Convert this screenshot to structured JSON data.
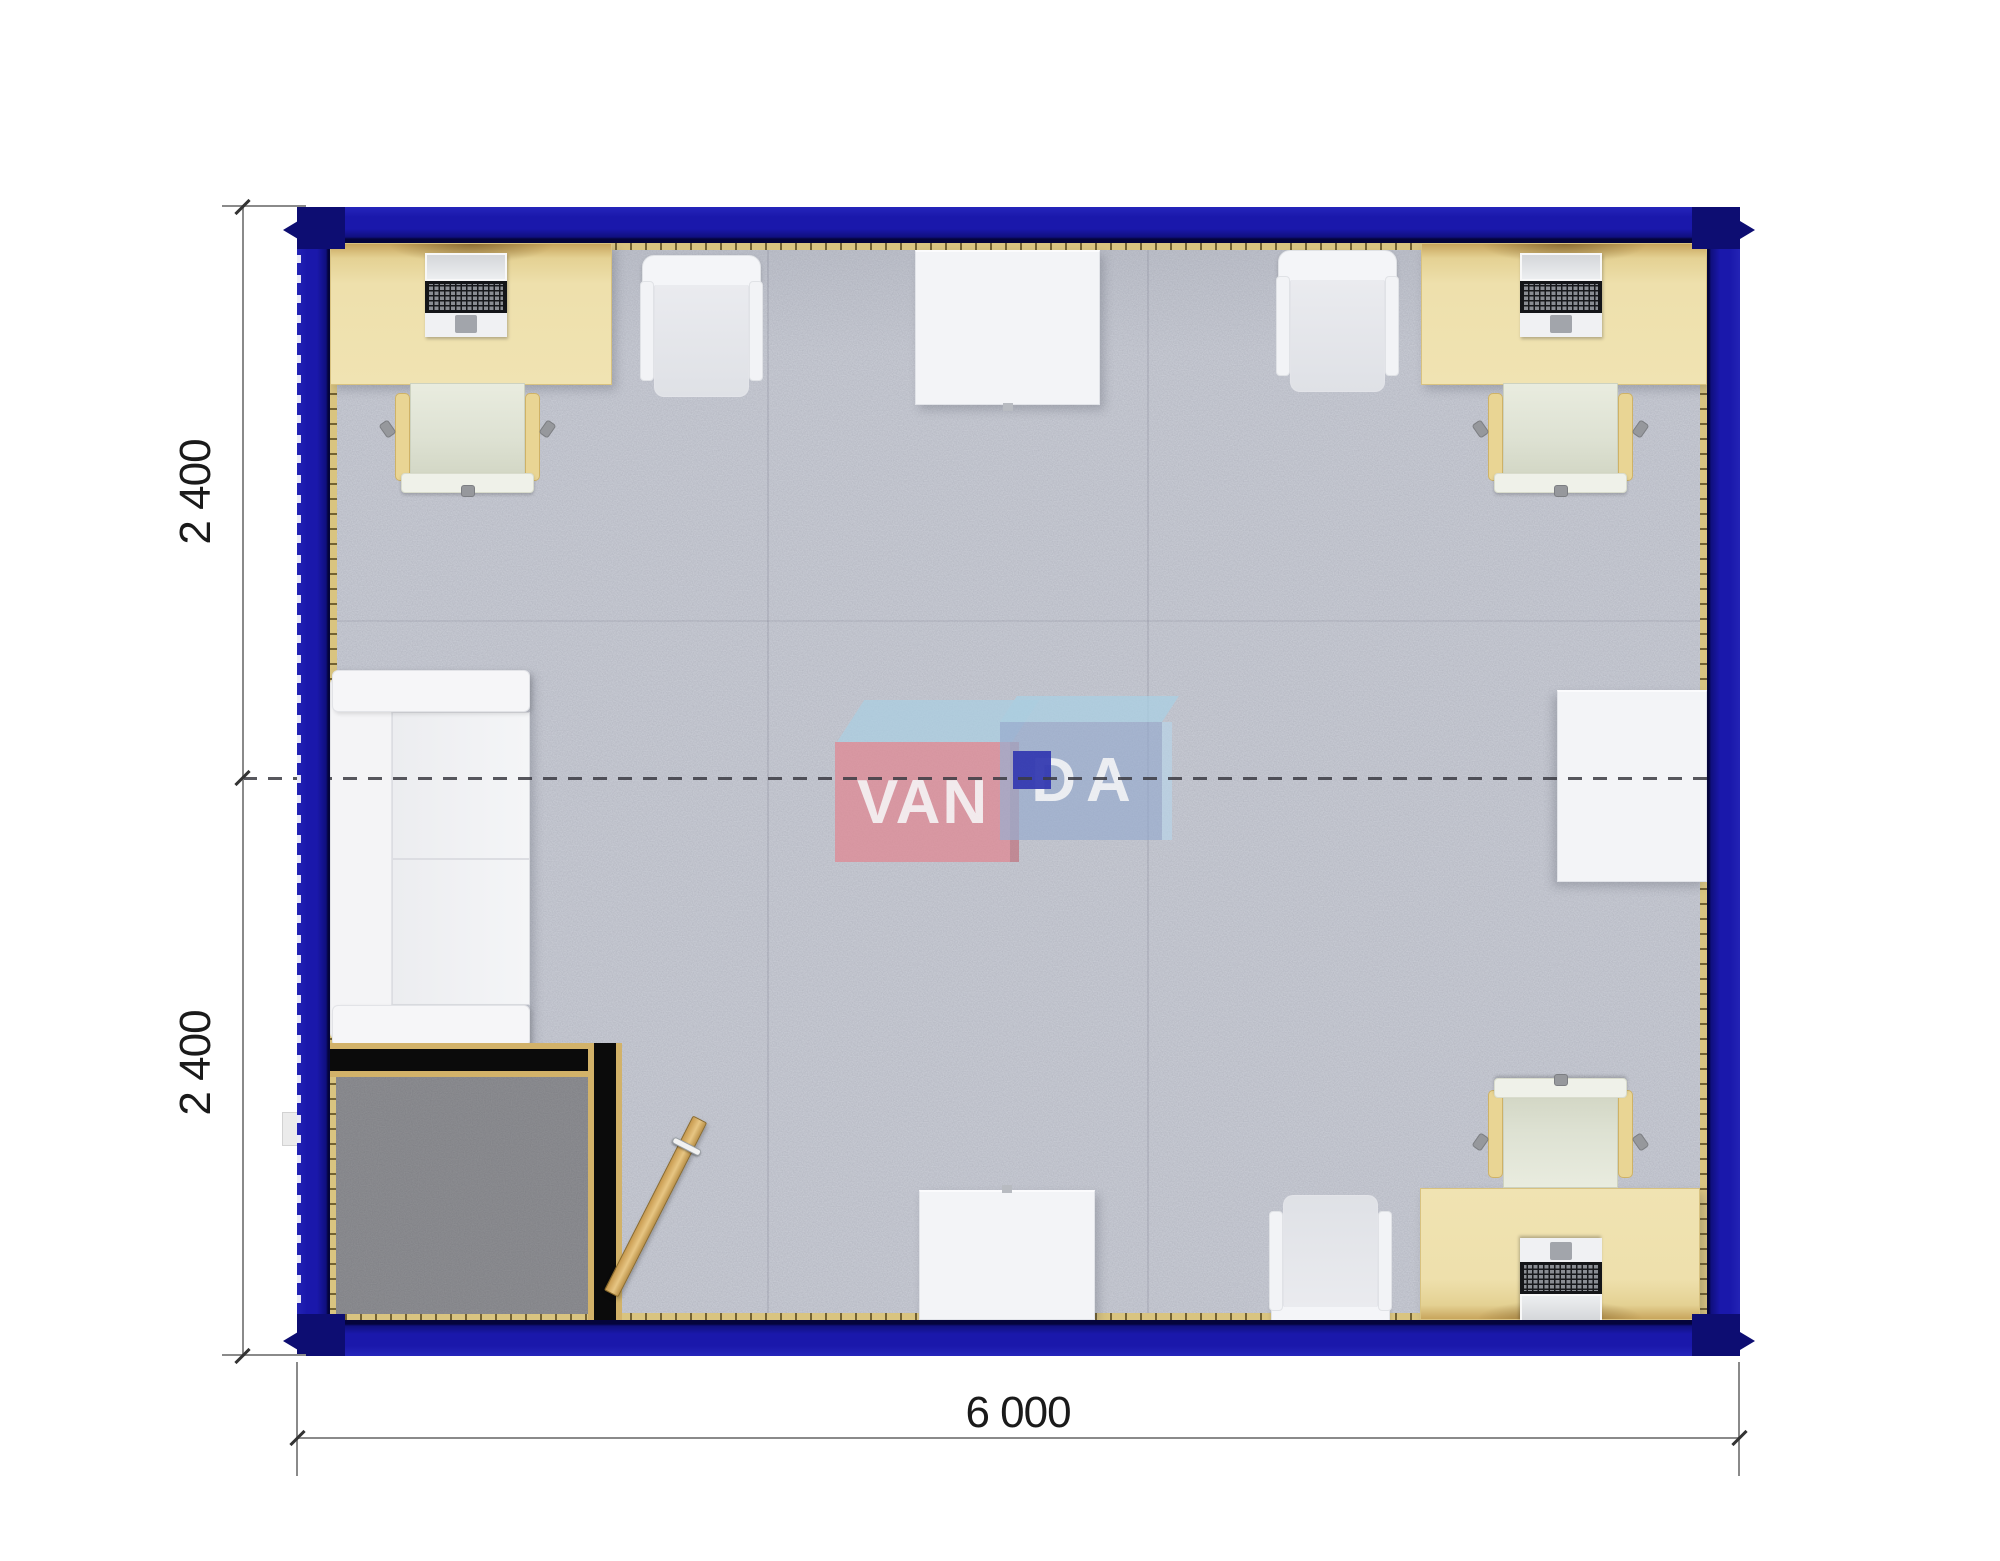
{
  "dimensions": {
    "left_top": "2 400",
    "left_bottom": "2 400",
    "bottom_width": "6 000"
  },
  "logo": {
    "left_text": "VAN",
    "right_text": "DA"
  },
  "furniture_inventory": {
    "desks_with_laptops": 3,
    "office_chairs": 3,
    "visitor_chairs": 3,
    "white_tables": 3,
    "sofas": 1,
    "entry_doors": 1,
    "entry_vestibules": 1
  },
  "colors": {
    "wall": "#1a18ab",
    "wall_edge": "#04043c",
    "wall_corner": "#0d0d72",
    "baseboard": "#d9c480",
    "carpet": "#c7cad3",
    "carpet_dark": "#8d8e92",
    "desk": "#f0e3b2",
    "chair_frame": "#e9d594",
    "white_furn": "#f3f4f7",
    "partition": "#0b0b0b",
    "partition_cap": "#d2b269",
    "door": "#dcb66c",
    "logo_pink": "#e2848f",
    "logo_blue": "#93a9cf",
    "logo_sky": "#a9d0e4",
    "logo_square": "#1e24ad",
    "dim_line": "#8a8a8a",
    "dim_text": "#1a1a1a",
    "centerline": "#3a3a42"
  }
}
